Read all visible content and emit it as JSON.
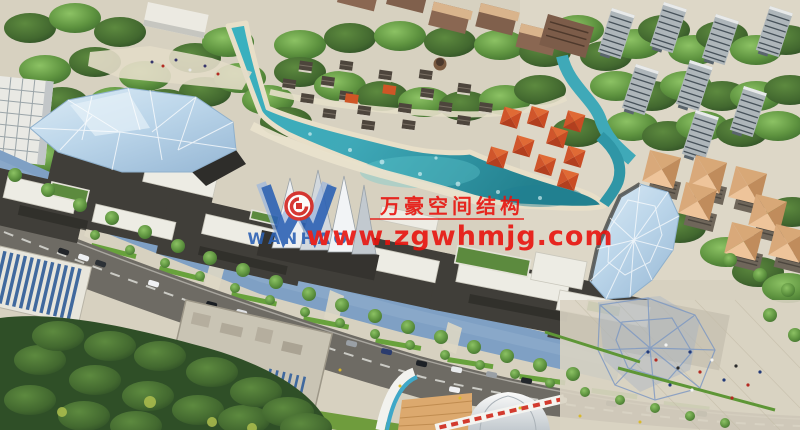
{
  "meta": {
    "description": "Aerial 3D architectural rendering of a lakeside commercial street complex with glass canopies, cottage village, residential towers and arterial road"
  },
  "watermark": {
    "logo_text": "WANHAO",
    "company_cn": "万豪空间结构",
    "website": "www.zgwhmjg.com",
    "text_color": "#e8130e",
    "logo_color": "#2d62b4"
  },
  "palette": {
    "lake_teal": "#3fa9b8",
    "glass_canopy_blue": "#bcd6ea",
    "tree_light_green": "#6fae4e",
    "forest_dark_green": "#33552a",
    "pavilion_orange": "#d0552b",
    "road_asphalt": "#6e6b64",
    "plaza_paving": "#d7d1c0",
    "riverside_walk_blue": "#7fa0c4",
    "mall_facade_dark": "#403e39",
    "roof_white": "#edece4",
    "apartment_roof_tan": "#dfb48c"
  }
}
